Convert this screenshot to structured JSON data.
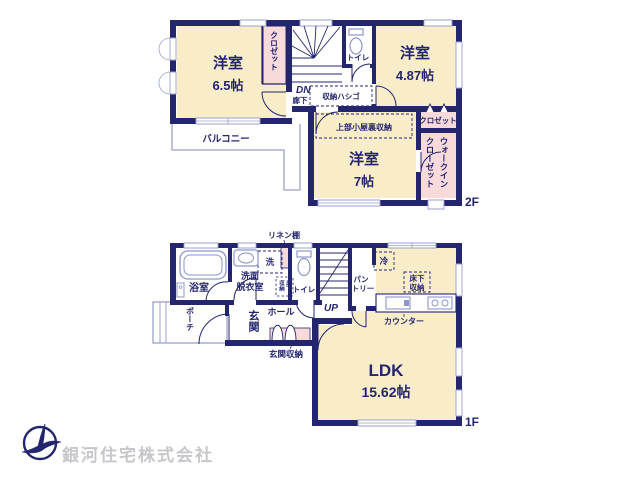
{
  "colors": {
    "wall": "#23256e",
    "room_fill": "#f9edc9",
    "closet_fill": "#f9dada",
    "fixture_line": "#8d96c8",
    "outdoor_line": "#9aa2c8",
    "company_text": "#c7c7cb"
  },
  "floor2": {
    "label": "2F",
    "room1_name": "洋室",
    "room1_size": "6.5帖",
    "room2_name": "洋室",
    "room2_size": "4.87帖",
    "room3_name": "洋室",
    "room3_size": "7帖",
    "closet1": "クロゼット",
    "closet2": "クロゼット",
    "wic_col1": "ウォークイン",
    "wic_col2": "クローゼット",
    "toilet": "トイレ",
    "corridor": "廊下",
    "dn": "DN",
    "storage_ladder": "収納ハシゴ",
    "attic_storage": "上部小屋裏収納",
    "balcony": "バルコニー"
  },
  "floor1": {
    "label": "1F",
    "bathroom": "浴室",
    "washroom_l1": "洗面",
    "washroom_l2": "脱衣室",
    "washer": "洗",
    "linen_shelf": "リネン棚",
    "underfloor1_c1": "床下",
    "underfloor1_c2": "収納",
    "toilet": "トイレ",
    "up": "UP",
    "pantry_l1": "パン",
    "pantry_l2": "トリー",
    "fridge": "冷",
    "underfloor2_l1": "床下",
    "underfloor2_l2": "収納",
    "counter": "カウンター",
    "hall": "ホール",
    "entrance": "玄関",
    "entrance_storage": "玄関収納",
    "porch": "ポーチ",
    "ldk_name": "LDK",
    "ldk_size": "15.62帖"
  },
  "company": {
    "name": "銀河住宅株式会社"
  }
}
